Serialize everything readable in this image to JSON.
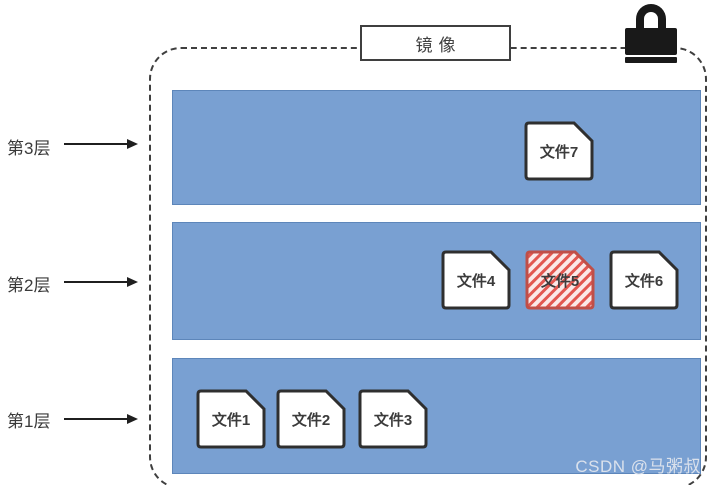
{
  "diagram": {
    "title_box": {
      "label": "镜像"
    },
    "lock_icon": "padlock-icon",
    "layers": [
      {
        "id": "layer3",
        "label": "第3层",
        "files": [
          "文件7"
        ]
      },
      {
        "id": "layer2",
        "label": "第2层",
        "files": [
          "文件4",
          "文件5",
          "文件6"
        ]
      },
      {
        "id": "layer1",
        "label": "第1层",
        "files": [
          "文件1",
          "文件2",
          "文件3"
        ]
      }
    ]
  },
  "layer_labels": {
    "layer3": "第3层",
    "layer2": "第2层",
    "layer1": "第1层"
  },
  "files": {
    "f1": "文件1",
    "f2": "文件2",
    "f3": "文件3",
    "f4": "文件4",
    "f5": "文件5",
    "f6": "文件6",
    "f7": "文件7"
  },
  "highlighted_file": "文件5",
  "watermark": "CSDN @马粥叔",
  "colors": {
    "layer_fill": "#79A0D2",
    "layer_border": "#5d86ba",
    "file_stroke": "#2f2f2f",
    "highlight_stripe": "#e25750",
    "highlight_bg": "#fbe9e8",
    "highlight_stroke": "#bf4f48",
    "lock": "#191919",
    "dashed_border": "#3f3f3f"
  }
}
